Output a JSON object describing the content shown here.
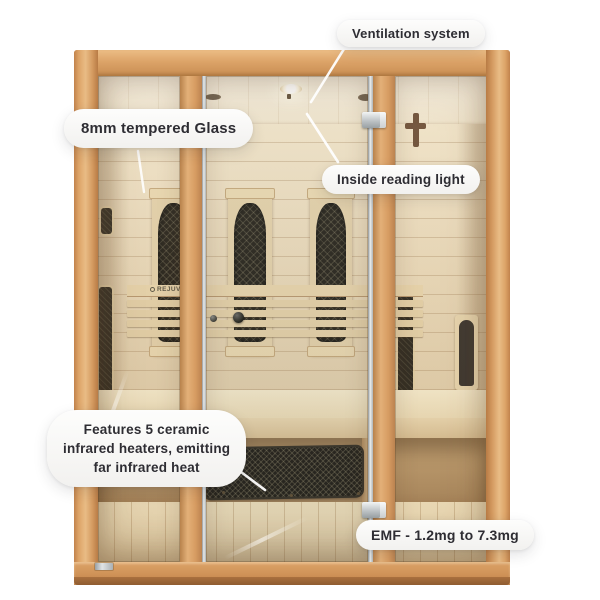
{
  "scene": {
    "type": "product-callout-image",
    "subject": "3-person far infrared sauna with wooden frame and glass front",
    "background": "#ffffff"
  },
  "callouts": [
    {
      "id": "ventilation",
      "label": "Ventilation system"
    },
    {
      "id": "tempered_glass",
      "label": "8mm tempered Glass"
    },
    {
      "id": "reading_light",
      "label": "Inside reading light"
    },
    {
      "id": "ceramic_heaters",
      "lines": [
        "Features 5 ceramic",
        "infrared heaters, emitting",
        "far infrared heat"
      ]
    },
    {
      "id": "emf",
      "label": "EMF - 1.2mg to 7.3mg"
    }
  ],
  "sauna": {
    "backrest_logo": "REJUVE"
  },
  "colors": {
    "frame_wood": "#d59a62",
    "frame_wood_light": "#e9bc85",
    "frame_wood_dark": "#b37c48",
    "interior_wall": "#e9d9bb",
    "ceiling": "#f4ecda",
    "bench_wood": "#efe1c0",
    "floor_wood": "#eddcb6",
    "heater_black": "#1f1c14",
    "aluminum": "#c9cdce",
    "pill_background": "#f7f6f4",
    "pill_text": "#2e2d33",
    "leader_line": "#ffffff"
  }
}
